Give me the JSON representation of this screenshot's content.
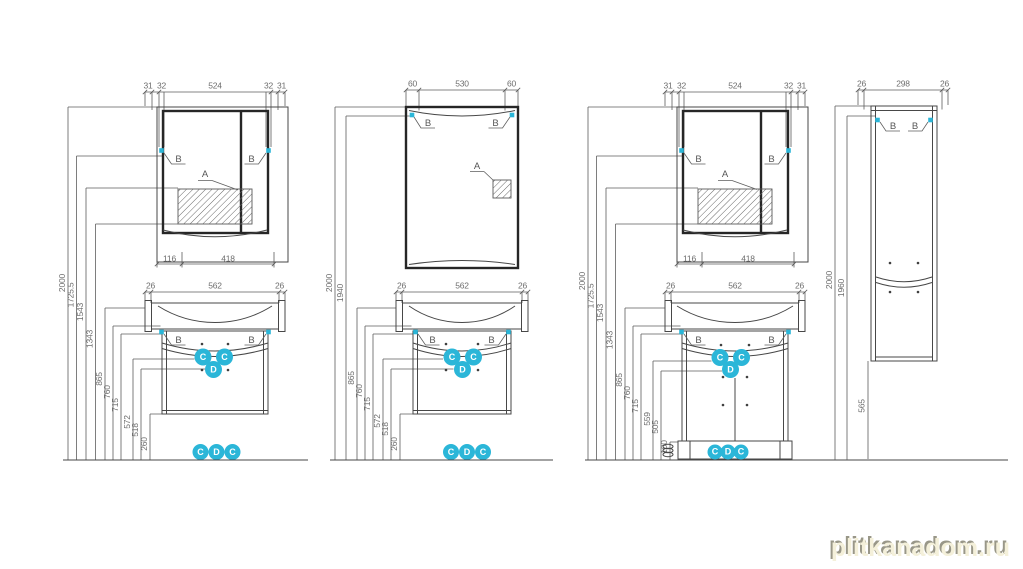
{
  "watermark": "plitkanadom.ru",
  "colors": {
    "accent_cyan": "#2bb6d8",
    "line_dark": "#262626",
    "line_gray": "#474747",
    "dim_text": "#6d6d6d",
    "watermark_fill": "#f4f0da"
  },
  "callouts": {
    "a": "A",
    "b": "B",
    "c": "C",
    "d": "D"
  },
  "panels": [
    {
      "name": "wall-hung-vanity-with-mirror-cabinet",
      "mirror_top_dims": [
        "31",
        "32",
        "524",
        "32",
        "31"
      ],
      "mirror_bottom_dims": [
        "116",
        "418"
      ],
      "height_dims": [
        "2000",
        "1725.5",
        "1543",
        "1343",
        "865",
        "760",
        "715",
        "572",
        "518",
        "260"
      ],
      "vanity_top_dims": [
        "26",
        "562",
        "26"
      ]
    },
    {
      "name": "mirror-with-wall-hung-vanity",
      "mirror_top_dims": [
        "60",
        "530",
        "60"
      ],
      "height_dims": [
        "2000",
        "1940",
        "865",
        "760",
        "715",
        "572",
        "518",
        "260"
      ],
      "vanity_top_dims": [
        "26",
        "562",
        "26"
      ]
    },
    {
      "name": "floor-standing-vanity-with-mirror-cabinet",
      "mirror_top_dims": [
        "31",
        "32",
        "524",
        "32",
        "31"
      ],
      "mirror_bottom_dims": [
        "116",
        "418"
      ],
      "height_dims": [
        "2000",
        "1725.5",
        "1543",
        "1343",
        "865",
        "760",
        "715",
        "559",
        "505",
        "100"
      ],
      "vanity_top_dims": [
        "26",
        "562",
        "26"
      ]
    },
    {
      "name": "tall-side-cabinet",
      "top_dims": [
        "26",
        "298",
        "26"
      ],
      "height_dims": [
        "2000",
        "1960"
      ],
      "bottom_clearance": "565"
    }
  ]
}
